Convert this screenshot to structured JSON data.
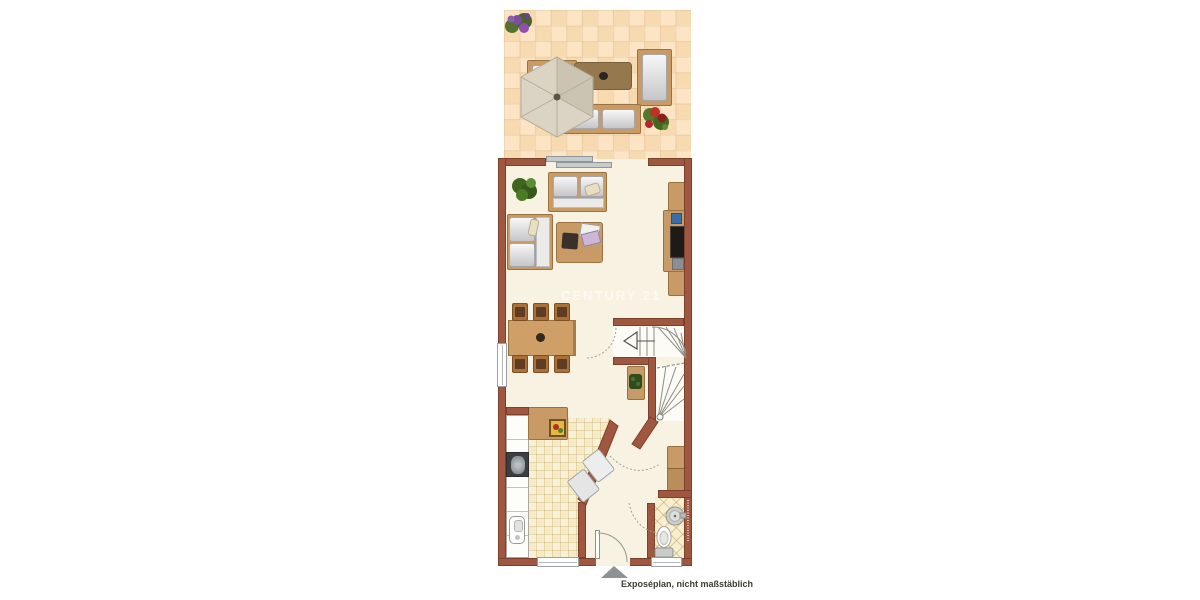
{
  "document": {
    "kind": "real-estate floor plan rendering"
  },
  "watermark": {
    "text": "CENTURY 21"
  },
  "caption": {
    "text": "Exposéplan, nicht maßstäblich"
  },
  "north_arrow": {
    "shape": "triangle-up",
    "color": "#8e9292"
  },
  "palette": {
    "background": "#ffffff",
    "wall": "#a0573f",
    "wall_border": "#7c412d",
    "interior_floor": "#f8f2e2",
    "terrace_tile_light": "#fce4c4",
    "terrace_tile_dark": "#f7dab0",
    "kitchen_tile": "#f6ebc5",
    "bath_tile": "#f7efcd",
    "wood_furniture": "#c79a66",
    "cushion": "#e9e9e7",
    "stair_background": "#fcfbf6",
    "window_frame": "#9aa0a3",
    "sliding_door": "#c7cbce"
  },
  "inventory": {
    "terrace": [
      "purple-flower-planter",
      "parasol",
      "lounge-sofa",
      "garden-coffee-table",
      "garden-bench",
      "garden-side-bench",
      "red-flower-planter",
      "sliding-terrace-door"
    ],
    "living_room": [
      "potted-plant",
      "two-seat-sofa",
      "corner-sofa",
      "coffee-table",
      "magazines",
      "media-sideboard",
      "tv"
    ],
    "dining_area": [
      "dining-table",
      "dining-chair-x6",
      "table-centerpiece",
      "side-window"
    ],
    "kitchen": [
      "kitchen-counter-left",
      "stove",
      "sink",
      "prep-counter",
      "wall-picture",
      "diagonal-counter",
      "bottom-window"
    ],
    "hall": [
      "stair-upper-flight",
      "stair-lower-flight",
      "stair-direction-arrow",
      "hall-cabinet-with-plant",
      "wardrobe",
      "entrance-door",
      "door-swing-arcs"
    ],
    "bathroom": [
      "round-washbasin",
      "toilet",
      "bottom-window"
    ]
  }
}
